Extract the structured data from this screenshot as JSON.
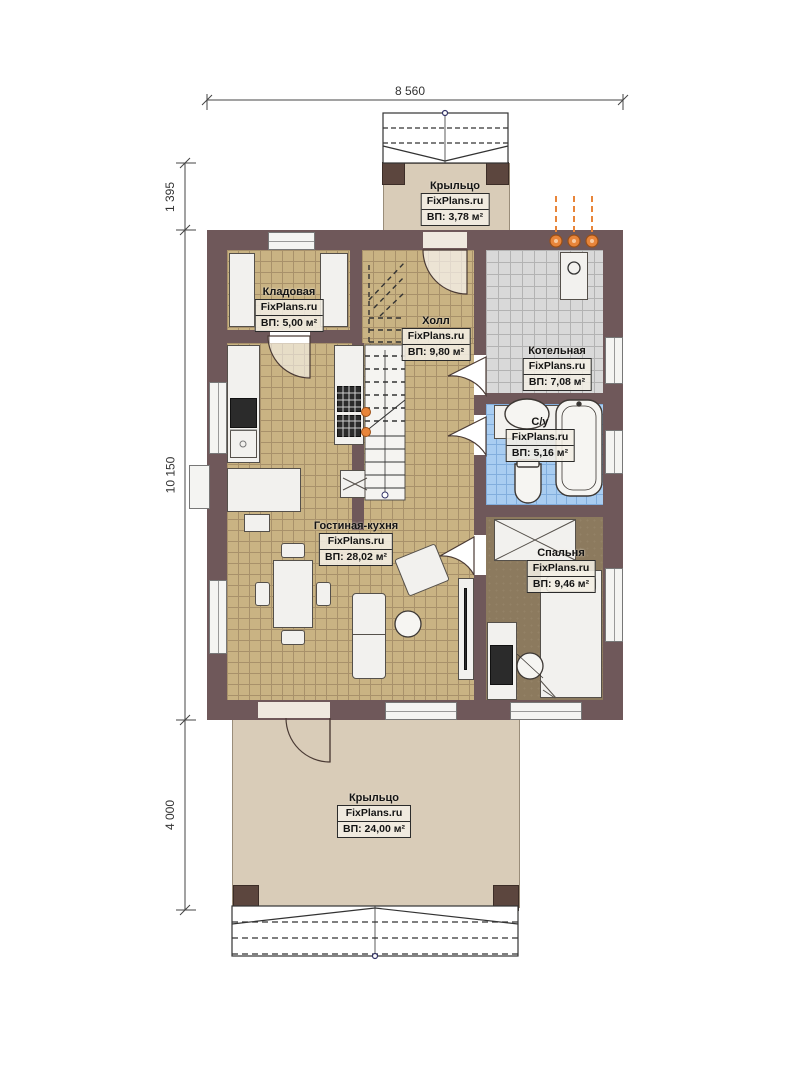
{
  "title": "План 1 этажа",
  "brand": "FixPlans.ru",
  "dimensions": {
    "top": "8 560",
    "left_top": "1 395",
    "left_middle": "10 150",
    "left_bottom": "4 000"
  },
  "rooms": {
    "porch_top": {
      "name": "Крыльцо",
      "brand": "FixPlans.ru",
      "area": "ВП: 3,78 м²"
    },
    "storage": {
      "name": "Кладовая",
      "brand": "FixPlans.ru",
      "area": "ВП: 5,00 м²"
    },
    "hall": {
      "name": "Холл",
      "brand": "FixPlans.ru",
      "area": "ВП: 9,80 м²"
    },
    "boiler": {
      "name": "Котельная",
      "brand": "FixPlans.ru",
      "area": "ВП: 7,08 м²"
    },
    "bathroom": {
      "name": "С/у",
      "brand": "FixPlans.ru",
      "area": "ВП: 5,16 м²"
    },
    "living_kitchen": {
      "name": "Гостиная-кухня",
      "brand": "FixPlans.ru",
      "area": "ВП: 28,02 м²"
    },
    "bedroom": {
      "name": "Спальня",
      "brand": "FixPlans.ru",
      "area": "ВП: 9,46 м²"
    },
    "porch_bottom": {
      "name": "Крыльцо",
      "brand": "FixPlans.ru",
      "area": "ВП: 24,00 м²"
    }
  },
  "colors": {
    "wall": "#6f585a",
    "tile_tan": "#c9b383",
    "tile_grey": "#d9d9d9",
    "tile_blue": "#a9cdf1",
    "bedroom_floor": "#8c7a5e",
    "porch_floor": "#d9ccb8",
    "pipe_orange": "#e8853a"
  }
}
